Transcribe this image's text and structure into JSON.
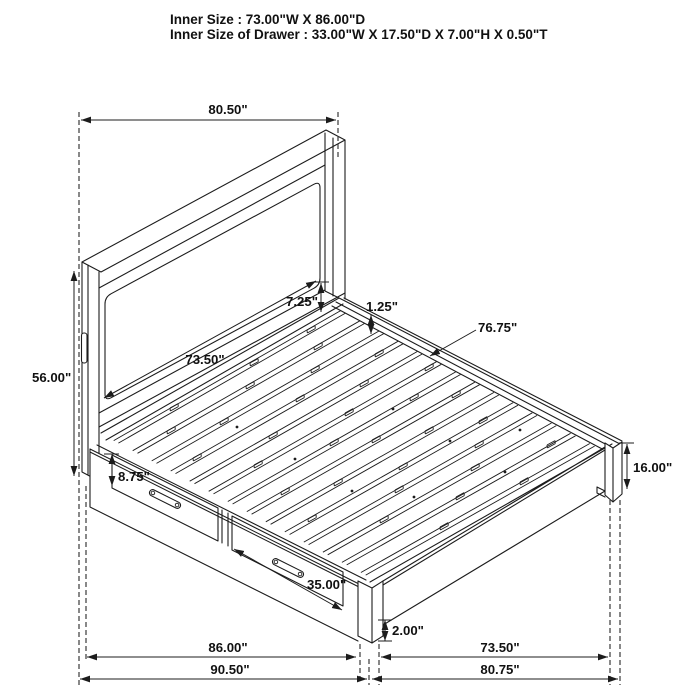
{
  "title_block": {
    "line1": "Inner Size : 73.00\"W X 86.00\"D",
    "line2": "Inner Size of Drawer : 33.00\"W X 17.50\"D X 7.00\"H X 0.50\"T"
  },
  "dims": {
    "headboard_width": "80.50\"",
    "headboard_height": "56.00\"",
    "headboard_inner_width": "73.50\"",
    "panel_to_deck": "7.25\"",
    "deck_lip": "1.25\"",
    "slat_span": "76.75\"",
    "drawer_height": "8.75\"",
    "drawer_width": "35.00\"",
    "clearance": "2.00\"",
    "foot_height": "16.00\"",
    "base_depth": "86.00\"",
    "overall_depth": "90.50\"",
    "inner_width": "73.50\"",
    "overall_width": "80.75\""
  },
  "style": {
    "ink": "#1c1c1c",
    "background": "#ffffff"
  }
}
